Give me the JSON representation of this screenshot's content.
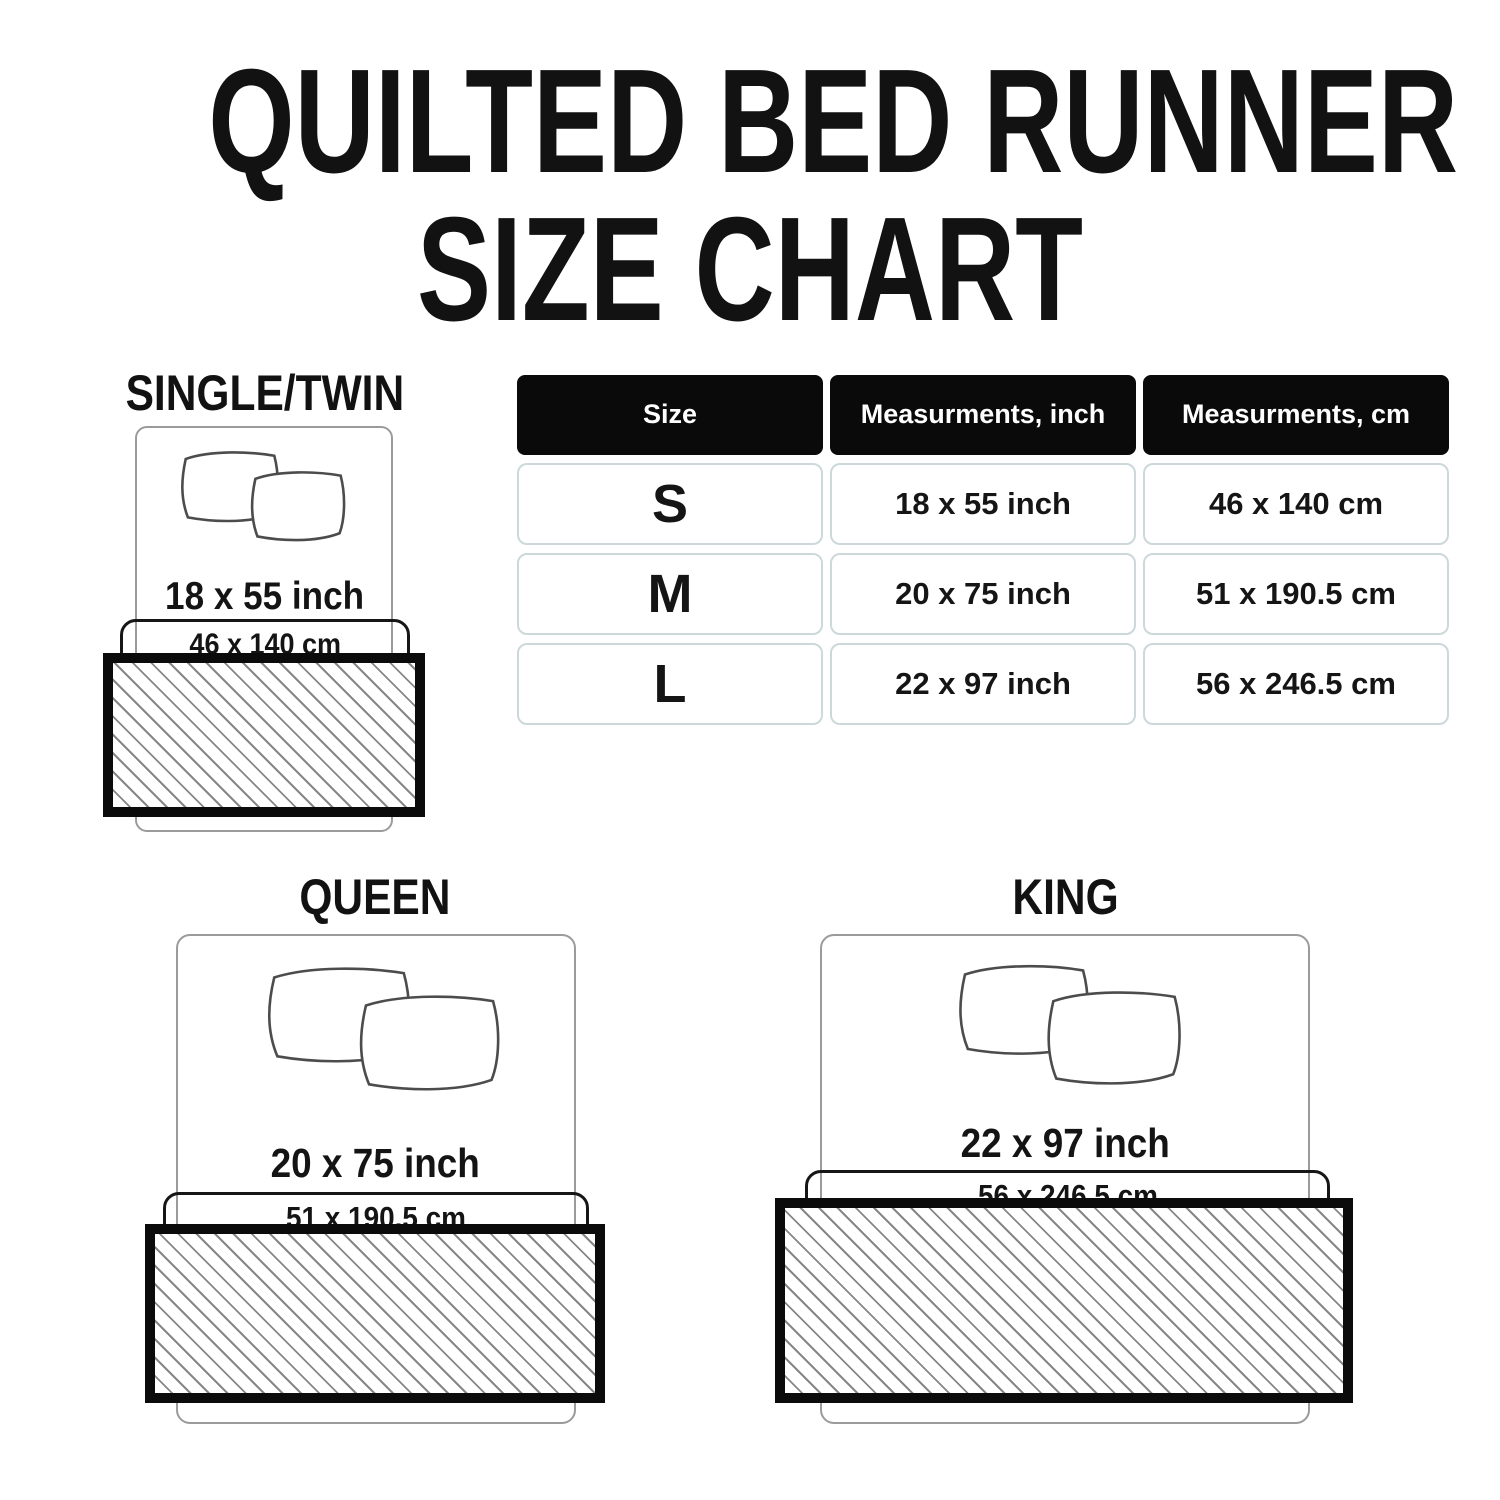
{
  "title": {
    "line1": "QUILTED BED RUNNER",
    "line2": "SIZE CHART"
  },
  "table": {
    "headers": [
      "Size",
      "Measurments, inch",
      "Measurments, cm"
    ],
    "rows": [
      {
        "size": "S",
        "inch": "18 x 55 inch",
        "cm": "46 x 140 cm"
      },
      {
        "size": "M",
        "inch": "20 x 75 inch",
        "cm": "51 x 190.5 cm"
      },
      {
        "size": "L",
        "inch": "22 x 97 inch",
        "cm": "56 x 246.5 cm"
      }
    ]
  },
  "diagrams": [
    {
      "name": "SINGLE/TWIN",
      "inch": "18 x 55 inch",
      "cm": "46 x 140 cm"
    },
    {
      "name": "QUEEN",
      "inch": "20 x 75 inch",
      "cm": "51 x 190.5 cm"
    },
    {
      "name": "KING",
      "inch": "22 x 97 inch",
      "cm": "56 x 246.5 cm"
    }
  ],
  "colors": {
    "header_bg": "#0a0a0a",
    "header_text": "#ffffff",
    "cell_border": "#ccd8da",
    "bed_outline": "#9b9b9b",
    "pillow_outline": "#4c4c4c",
    "runner_border": "#0b0b0b",
    "hatch_line": "#878787",
    "text": "#141414"
  }
}
